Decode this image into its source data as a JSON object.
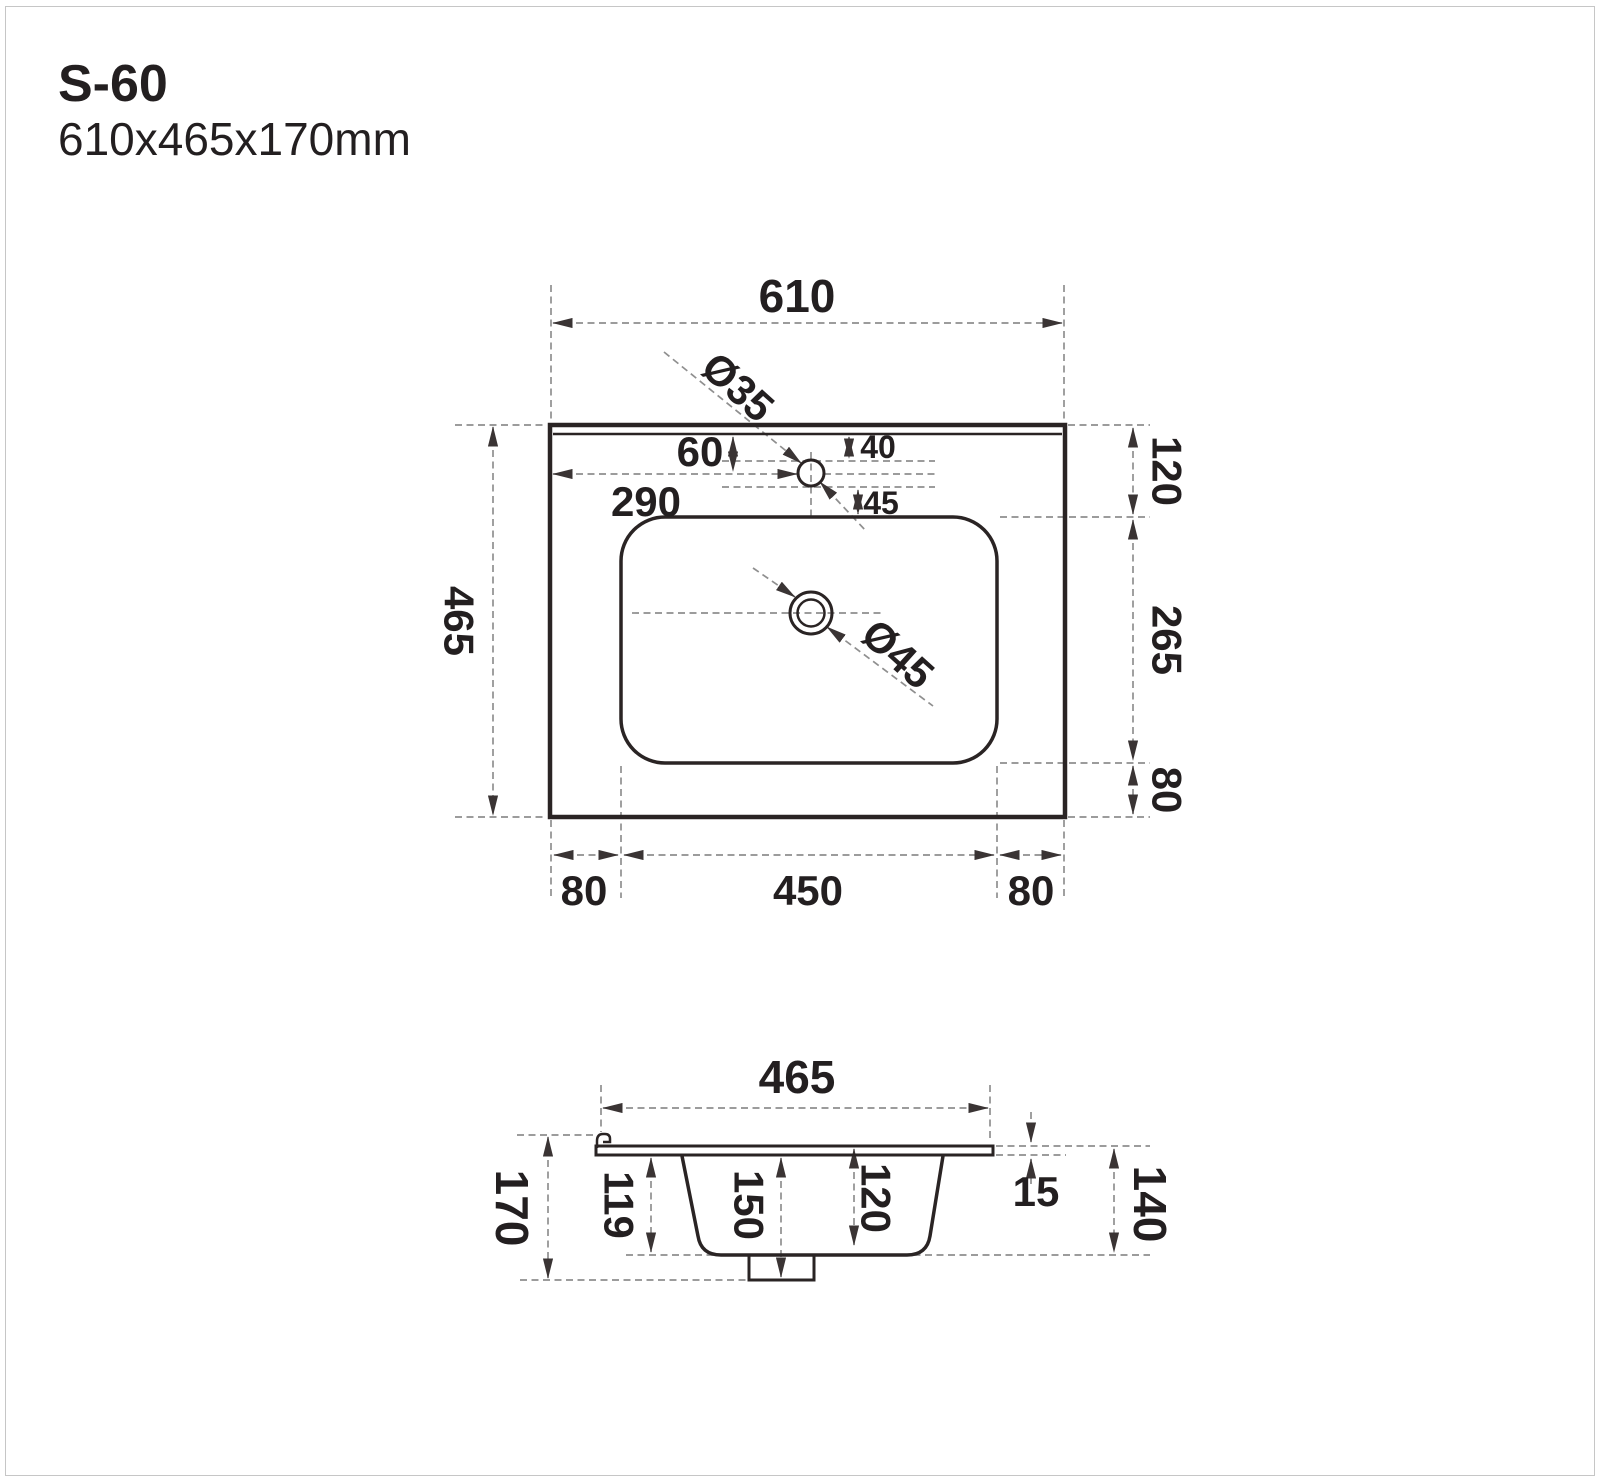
{
  "title": {
    "model": "S-60",
    "dimensions": "610x465x170mm"
  },
  "top_view": {
    "width": "610",
    "depth": "465",
    "faucet_dia": "Ø35",
    "drain_dia": "Ø45",
    "faucet_from_left": "290",
    "faucet_from_top": "60",
    "hole_top_offset": "40",
    "hole_bottom_offset": "45",
    "right_back": "120",
    "right_basin": "265",
    "right_front": "80",
    "front_left": "80",
    "basin_width": "450",
    "front_right": "80"
  },
  "side_view": {
    "depth": "465",
    "height": "170",
    "bowl_depth": "119",
    "drain_total": "150",
    "bowl_inner": "120",
    "rim": "15",
    "back_height": "140"
  },
  "colors": {
    "line": "#2a2424",
    "dashed": "#8f8f8f",
    "text": "#231f20"
  }
}
